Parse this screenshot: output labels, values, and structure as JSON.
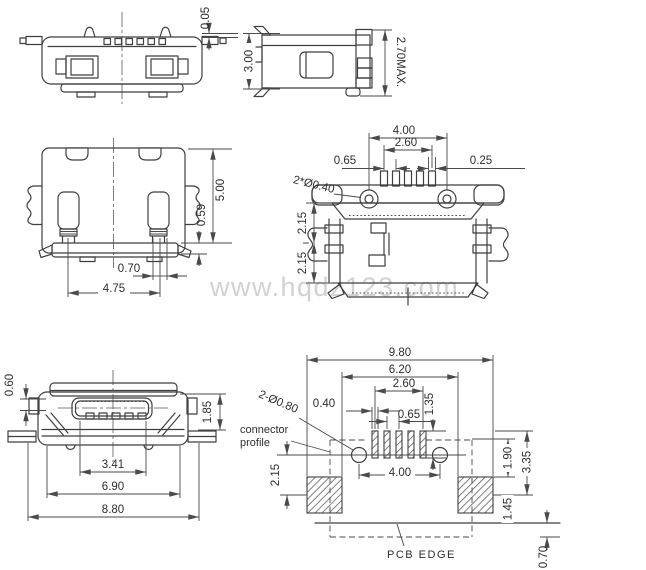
{
  "watermark": "www.hqdz123.com",
  "colors": {
    "line": "#3f3f3f",
    "dim": "#4a4a4a",
    "text": "#2e2e2e",
    "watermark": "#d2d2d2",
    "hatch": "#555555"
  },
  "views": {
    "top_view_a": {
      "dims": {
        "gap": "0.05"
      }
    },
    "side_view": {
      "dims": {
        "height": "3.00",
        "max_height": "2.70MAX."
      }
    },
    "rear_view": {
      "dims": {
        "height": "5.00",
        "foot_height": "0.59",
        "foot_width": "0.70",
        "foot_span": "4.75"
      }
    },
    "top_view_b": {
      "dims": {
        "hole_span": "4.00",
        "pin_span": "2.60",
        "pin_pitch": "0.65",
        "pin_width": "0.25",
        "hole_dia": "2*Ø0.40",
        "upper": "2.15",
        "lower": "2.15"
      }
    },
    "front_view": {
      "dims": {
        "tab": "0.60",
        "opening_height": "1.85",
        "opening_width": "3.41",
        "shell_width": "6.90",
        "total_width": "8.80"
      }
    },
    "footprint": {
      "dims": {
        "total_width": "9.80",
        "inner_width": "6.20",
        "pin_span": "2.60",
        "pad_width": "0.40",
        "pin_pitch": "0.65",
        "pad_height": "1.35",
        "hole_dia": "2-Ø0.80",
        "hole_offset": "2.15",
        "hole_span": "4.00",
        "pad_top_offset": "1.90",
        "pad_center_offset": "3.35",
        "edge_offset": "1.45",
        "overhang": "0.70"
      },
      "labels": {
        "profile_line1": "connector",
        "profile_line2": "profile",
        "pcb_edge": "PCB EDGE"
      }
    }
  }
}
